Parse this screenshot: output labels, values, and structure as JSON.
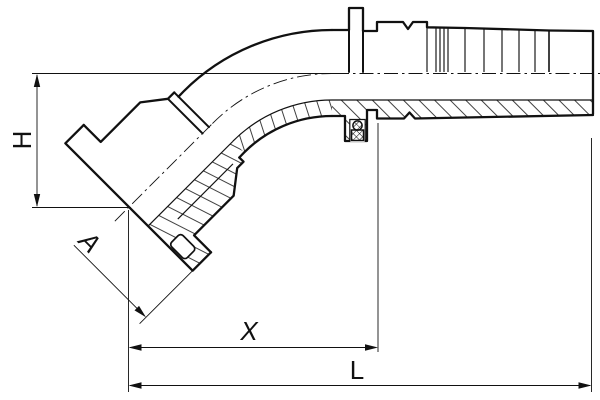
{
  "drawing": {
    "labels": {
      "height": "H",
      "flange": "A",
      "cutoff": "X",
      "overall_length": "L"
    },
    "colors": {
      "line": "#111111",
      "background": "#ffffff"
    }
  }
}
